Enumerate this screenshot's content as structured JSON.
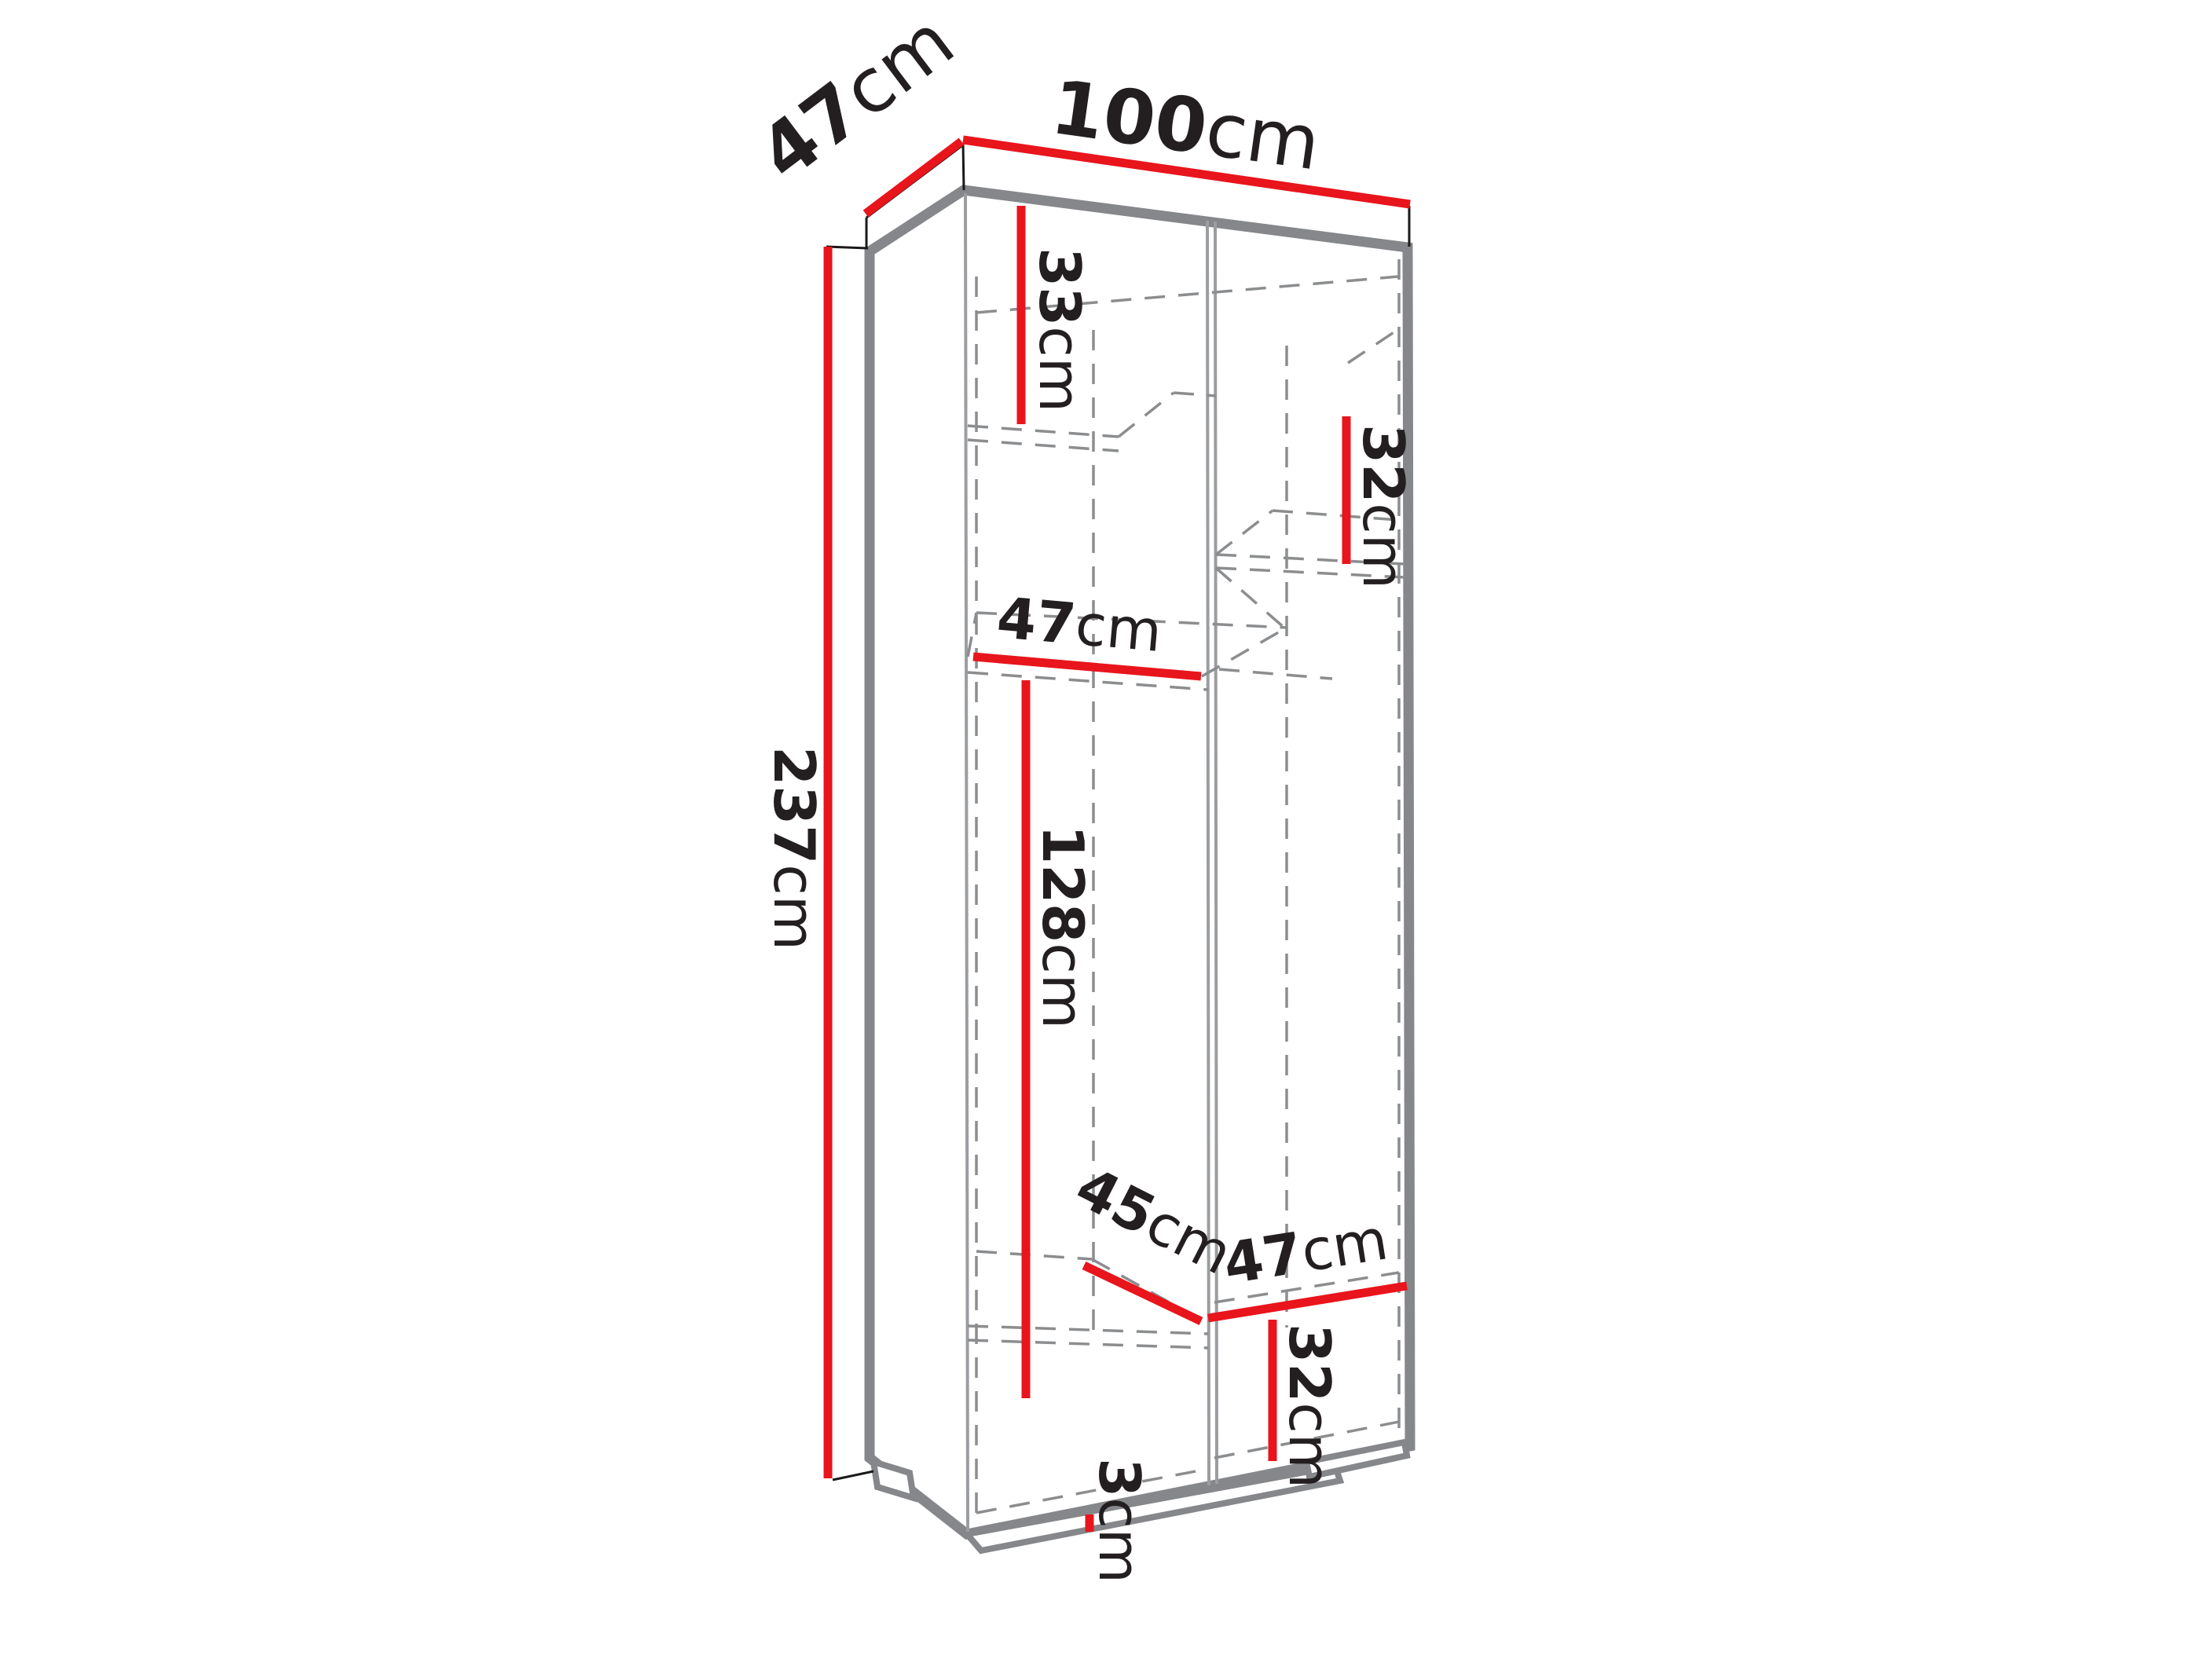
{
  "diagram": {
    "description": "Technical dimension drawing of a tall two-column wardrobe cabinet shown in pseudo-3D outline with red dimension lines",
    "unit": "cm",
    "overall": {
      "width": "100",
      "depth": "47",
      "height": "237"
    },
    "labels": {
      "depth_top": {
        "value": "47",
        "unit": "cm"
      },
      "width_top": {
        "value": "100",
        "unit": "cm"
      },
      "height_left": {
        "value": "237",
        "unit": "cm"
      },
      "top_left_compartment_height": {
        "value": "33",
        "unit": "cm"
      },
      "top_right_compartment_height": {
        "value": "32",
        "unit": "cm"
      },
      "left_shelf_width": {
        "value": "47",
        "unit": "cm"
      },
      "hanging_space_height": {
        "value": "128",
        "unit": "cm"
      },
      "bottom_left_compartment_depth": {
        "value": "45",
        "unit": "cm"
      },
      "bottom_right_shelf_depth": {
        "value": "47",
        "unit": "cm"
      },
      "bottom_right_compartment_height": {
        "value": "32",
        "unit": "cm"
      },
      "plinth_height": {
        "value": "3",
        "unit": "cm"
      }
    },
    "colors": {
      "dimension_line": "#e8151c",
      "cabinet_outline": "#85878a",
      "hidden_edge": "#8b8d8f",
      "extension_line": "#1a1a1a",
      "label_text": "#231f20",
      "background": "#ffffff"
    }
  }
}
